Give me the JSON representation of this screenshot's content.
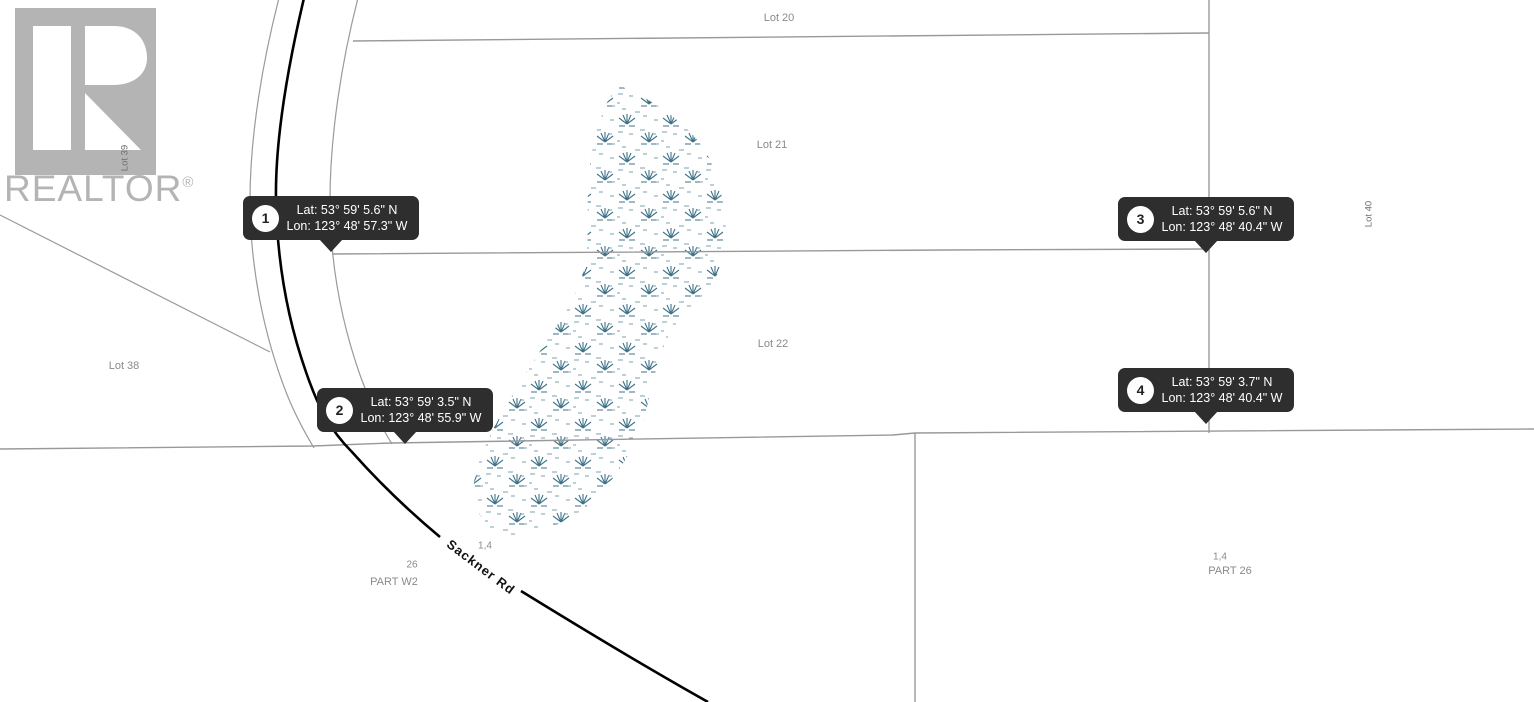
{
  "colors": {
    "marker_bg": "#2e2e2e",
    "marker_text": "#ffffff",
    "line_gray": "#999999",
    "road_black": "#000000",
    "wetland_teal": "#3e7389",
    "watermark_gray": "#b4b4b4",
    "label_gray": "#8a8a8a"
  },
  "watermark": {
    "brand": "REALTOR",
    "registered": "®"
  },
  "lots": {
    "lot20": "Lot 20",
    "lot21": "Lot 21",
    "lot22": "Lot 22",
    "lot38": "Lot 38",
    "lot39": "Lot 39",
    "lot40": "Lot 40"
  },
  "road": {
    "name": "Sackner Rd"
  },
  "parcel_annotations": {
    "left_fraction": "1,4",
    "left_number": "26",
    "left_part": "PART W2",
    "right_fraction": "1,4",
    "right_part": "PART 26"
  },
  "markers": [
    {
      "number": "1",
      "lat": "Lat: 53° 59' 5.6\" N",
      "lon": "Lon: 123° 48' 57.3\" W"
    },
    {
      "number": "2",
      "lat": "Lat: 53° 59' 3.5\" N",
      "lon": "Lon: 123° 48' 55.9\" W"
    },
    {
      "number": "3",
      "lat": "Lat: 53° 59' 5.6\" N",
      "lon": "Lon: 123° 48' 40.4\" W"
    },
    {
      "number": "4",
      "lat": "Lat: 53° 59' 3.7\" N",
      "lon": "Lon: 123° 48' 40.4\" W"
    }
  ]
}
